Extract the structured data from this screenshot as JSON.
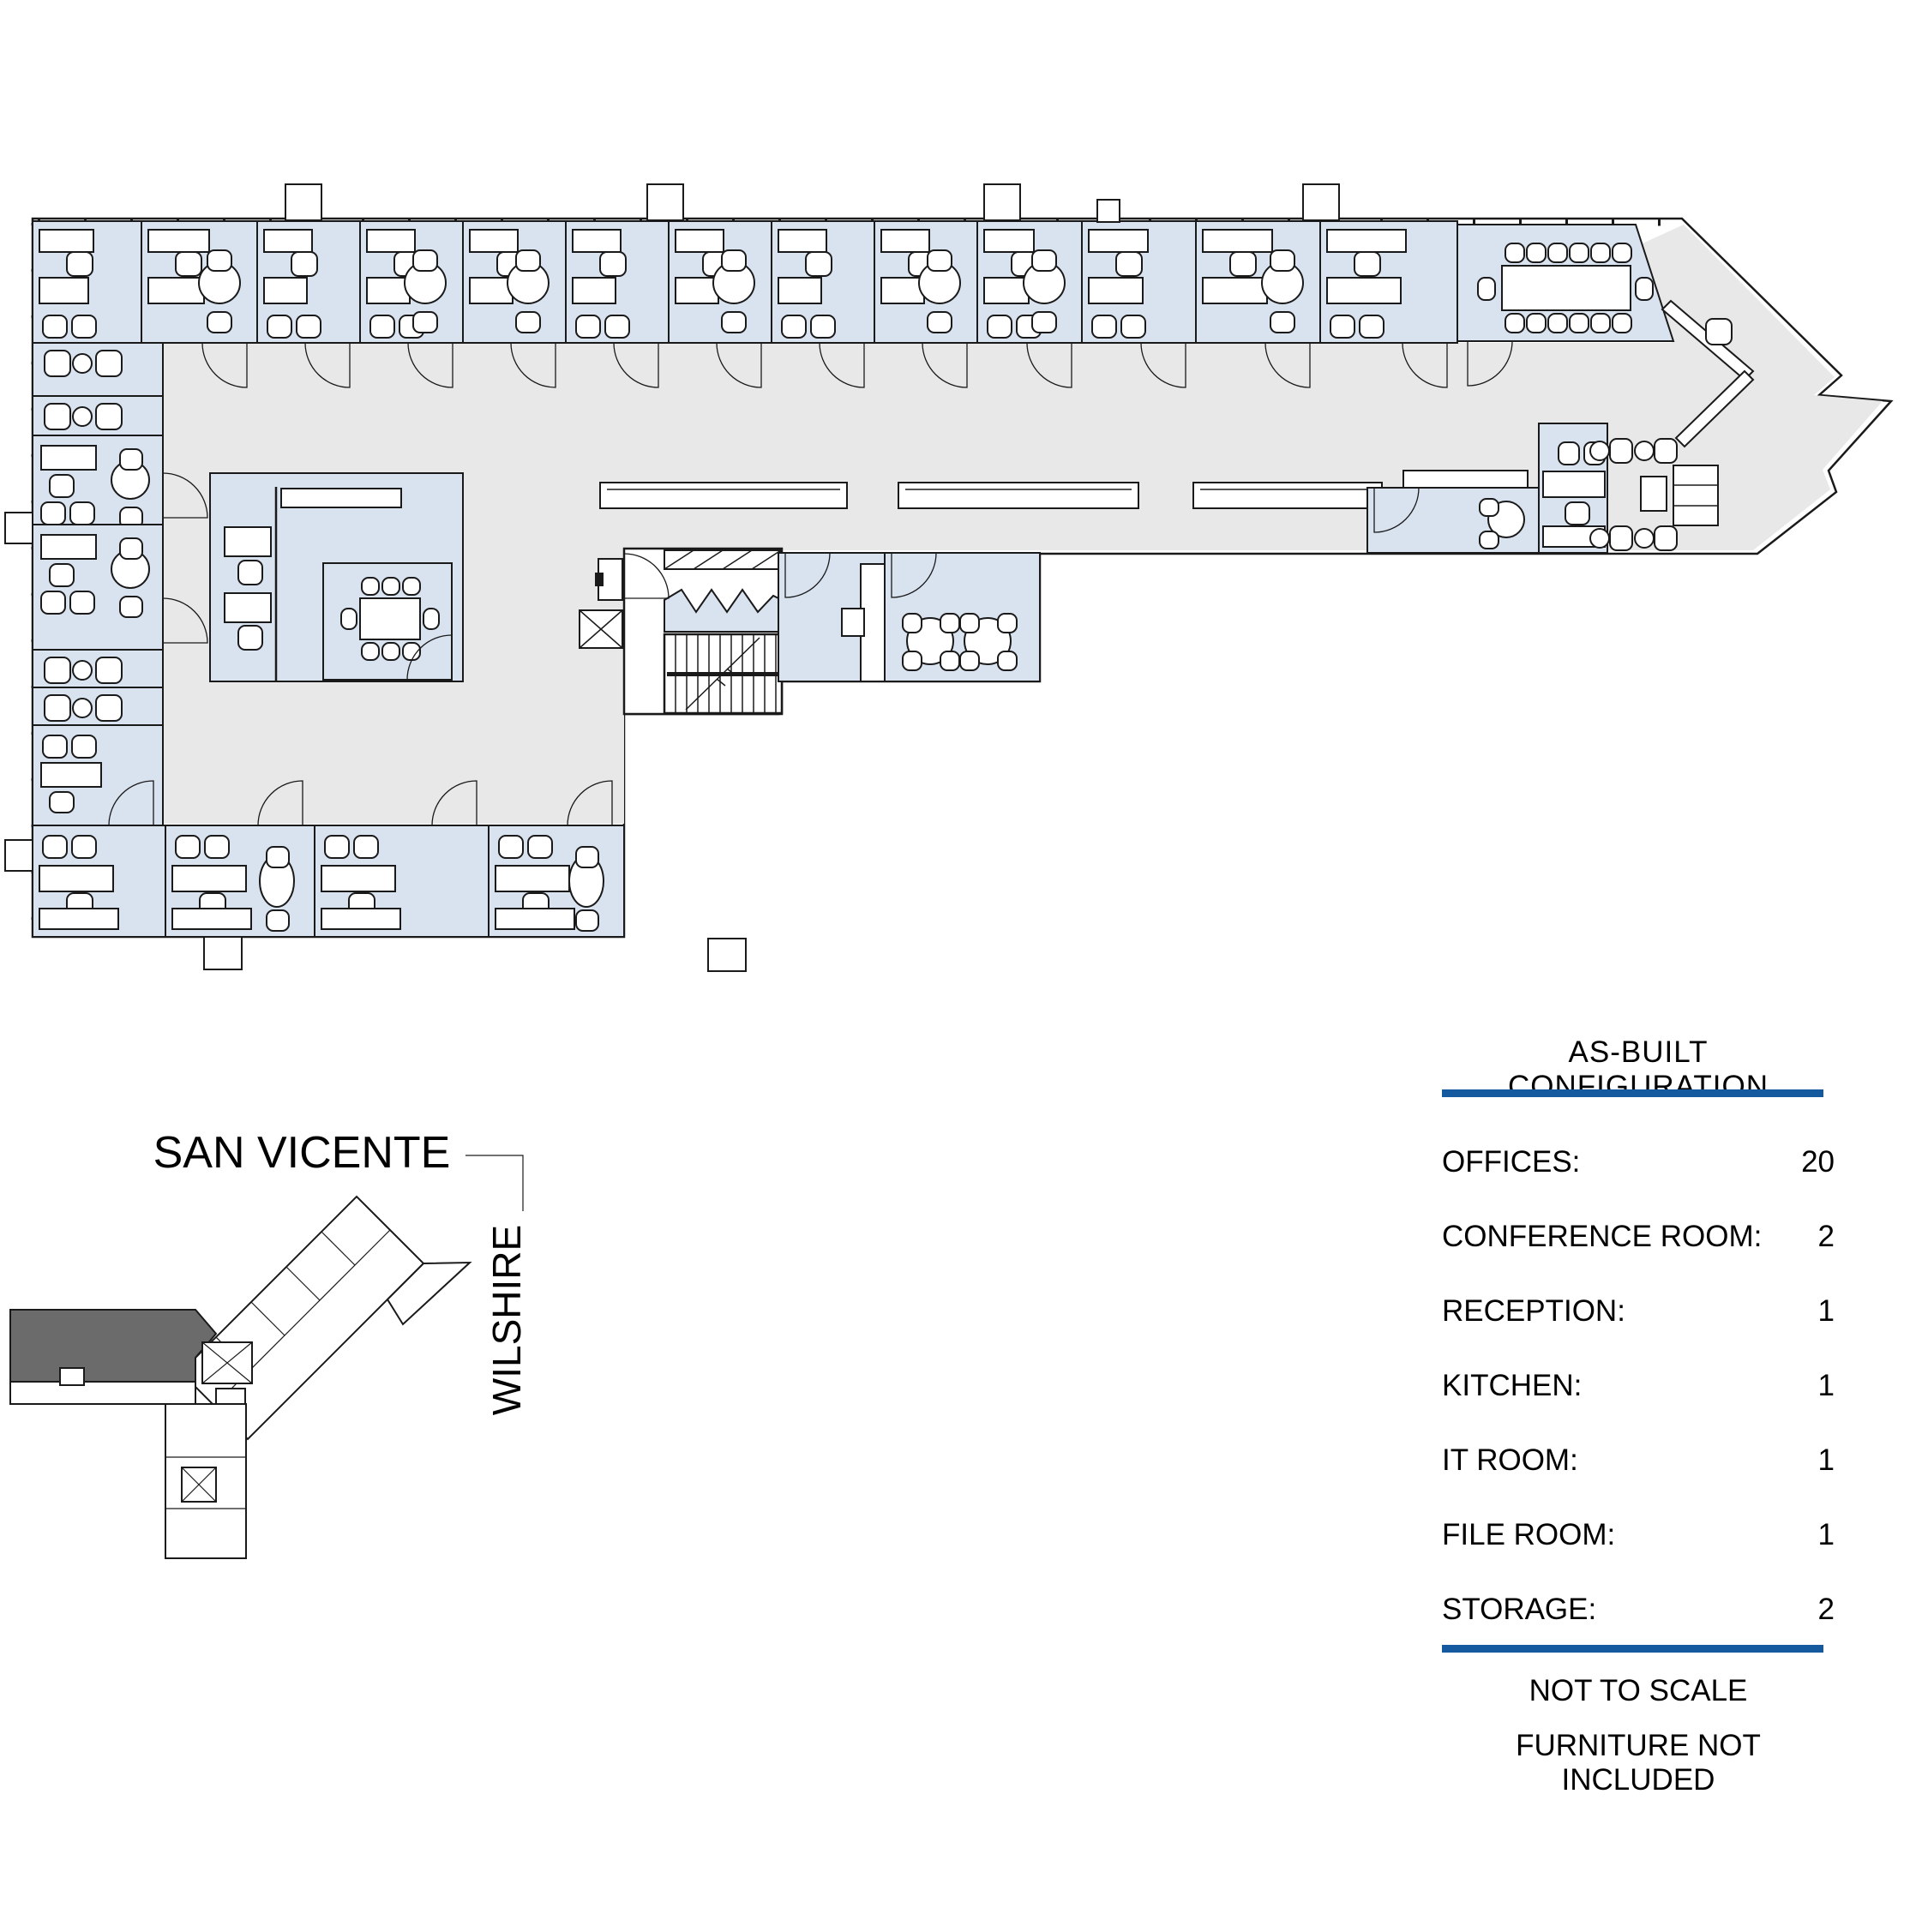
{
  "site_plan": {
    "street_top": "SAN VICENTE",
    "street_right": "WILSHIRE"
  },
  "legend": {
    "title": "AS-BUILT CONFIGURATION",
    "rows": [
      {
        "label": "OFFICES:",
        "value": "20"
      },
      {
        "label": "CONFERENCE ROOM:",
        "value": "2"
      },
      {
        "label": "RECEPTION:",
        "value": "1"
      },
      {
        "label": "KITCHEN:",
        "value": "1"
      },
      {
        "label": "IT ROOM:",
        "value": "1"
      },
      {
        "label": "FILE ROOM:",
        "value": "1"
      },
      {
        "label": "STORAGE:",
        "value": "2"
      }
    ],
    "notes": [
      "NOT TO SCALE",
      "FURNITURE NOT INCLUDED"
    ],
    "accent_color": "#15599e"
  },
  "colors": {
    "office_fill": "#d9e3f0",
    "circulation_fill": "#e8e8e8",
    "wall": "#1a1a1a",
    "site_highlight": "#6b6b6b"
  }
}
